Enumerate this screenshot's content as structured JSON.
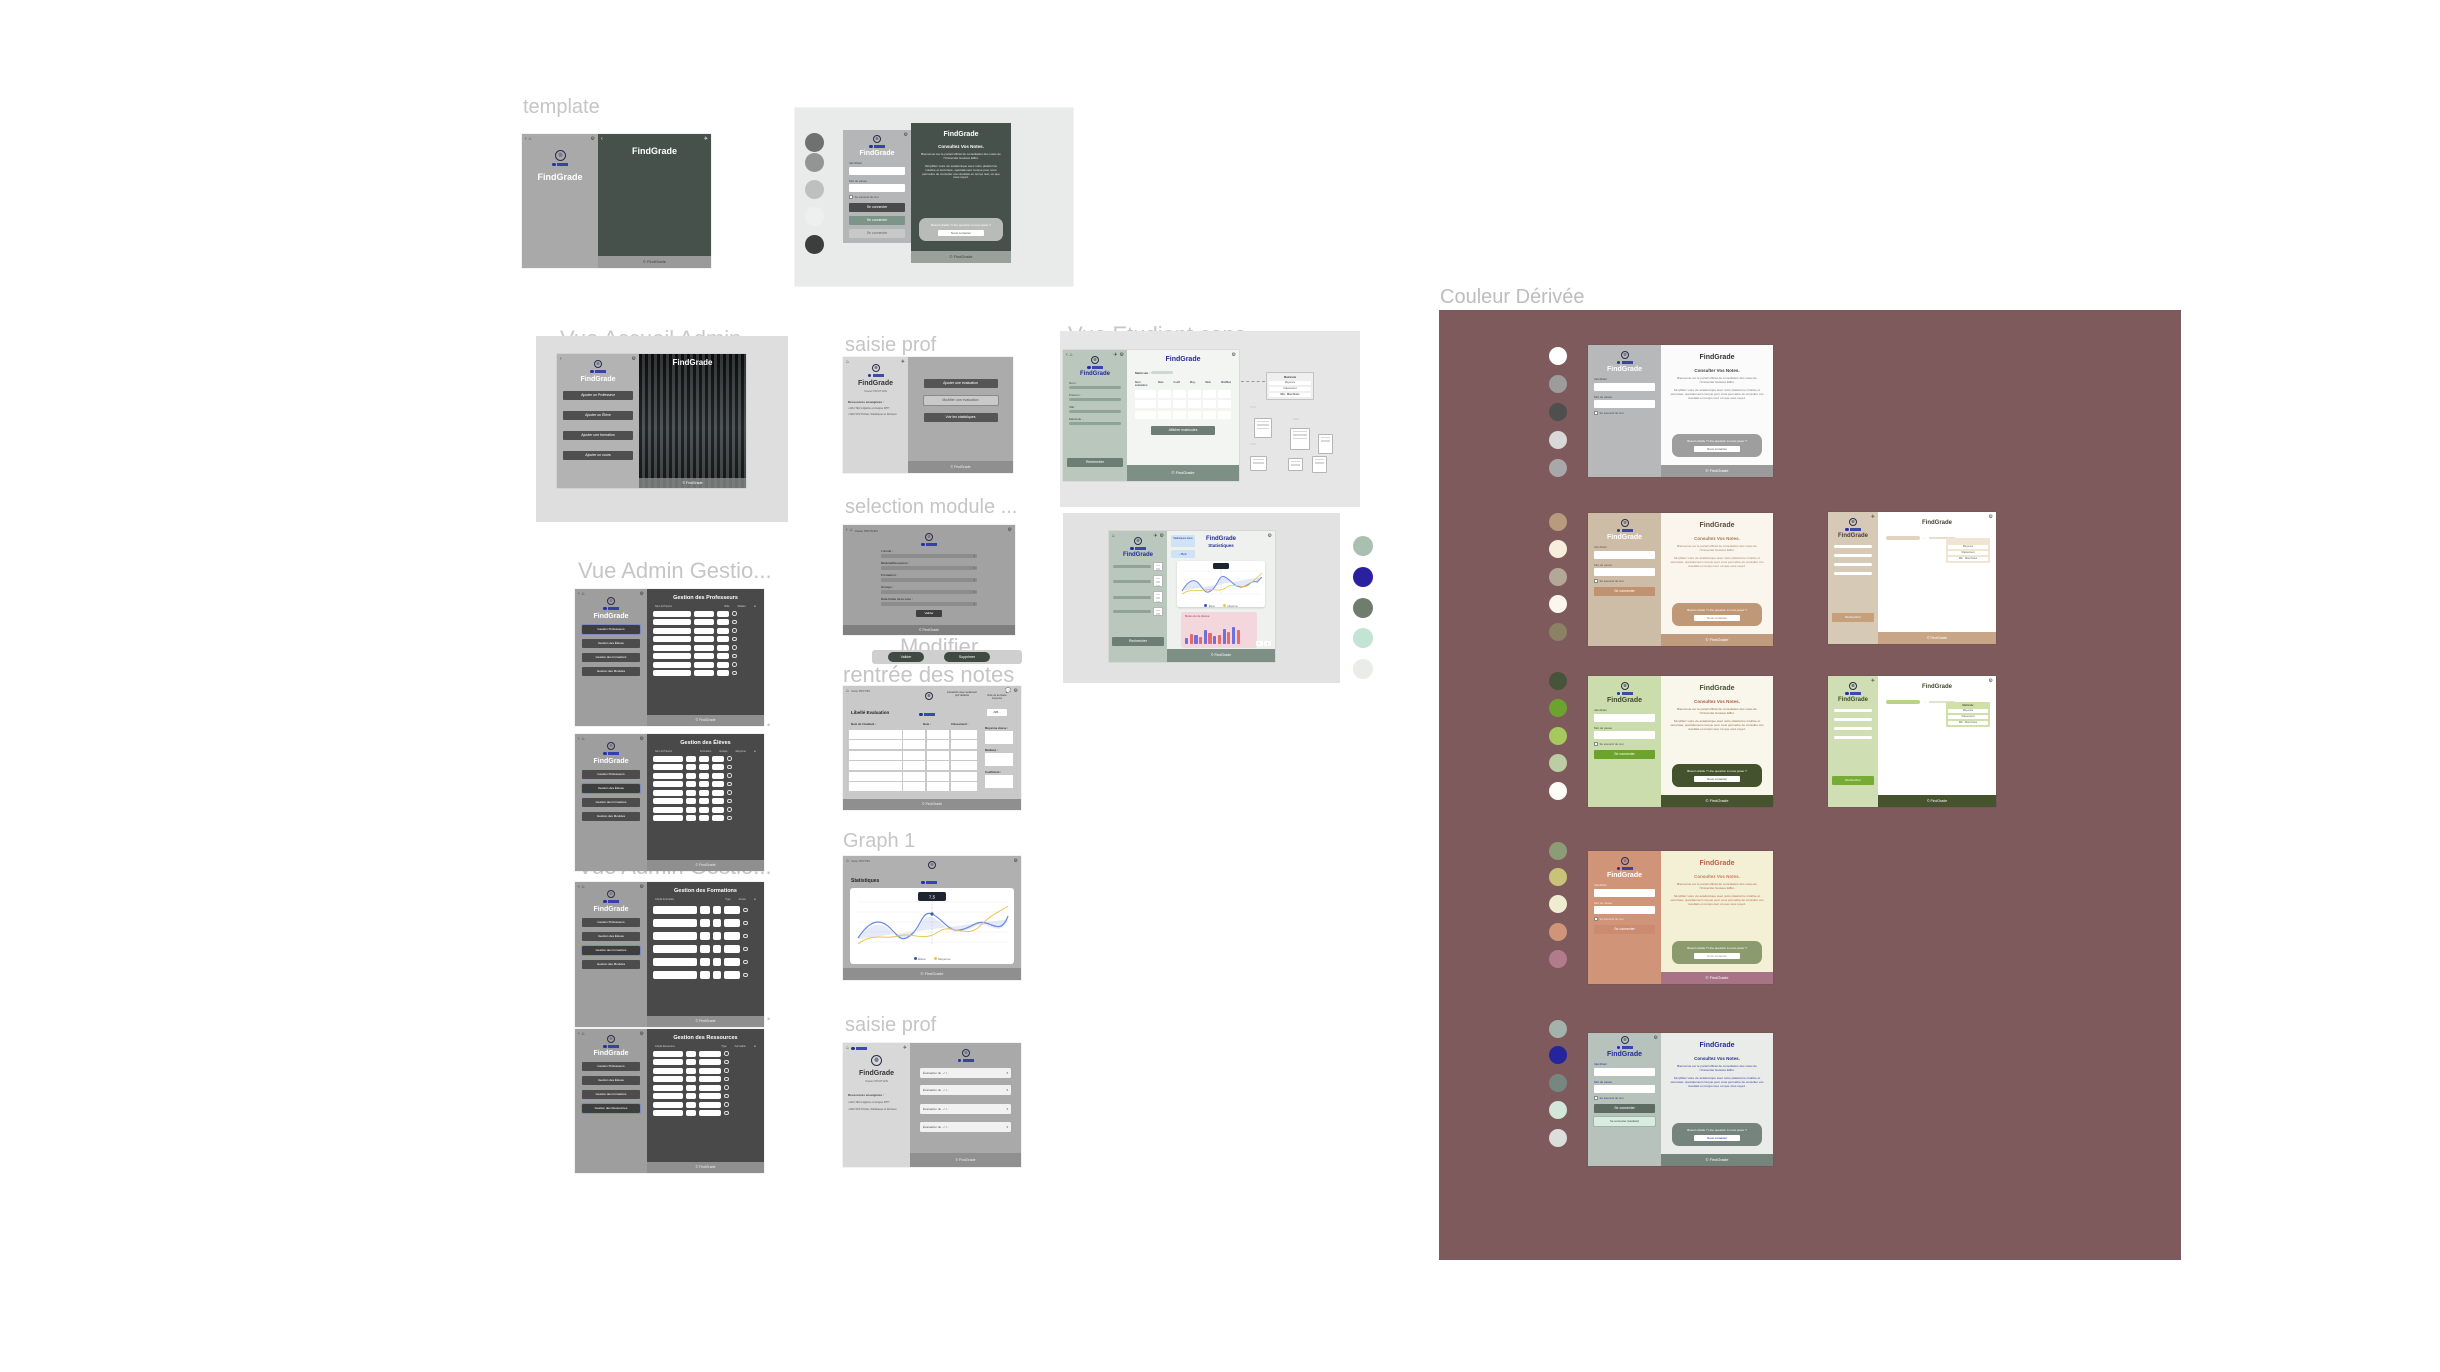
{
  "app": {
    "name": "FindGrade",
    "copyright": "© FindGrade"
  },
  "labels": {
    "template": "template",
    "accueil_admin": "Vue Accueil Admin",
    "admin_gestion": "Vue Admin Gestio...",
    "saisie_prof": "saisie prof",
    "selection_module": "selection module ...",
    "modifier": "Modifier...",
    "rentree_notes": "rentrée des notes",
    "graph1": "Graph 1",
    "etudiant_cons": "Vue Etudiant cons...",
    "etudiant_stat": "Vue Étudiant stat...",
    "couleur_derivee": "Couleur Dérivée"
  },
  "login": {
    "identifiant": "Identifiant",
    "mot_de_passe": "Mot de passe",
    "remember": "Se souvenir de moi",
    "se_connecter": "Se connecter",
    "se_connecter_etudiant": "Se connecter (étudiant)"
  },
  "welcome": {
    "heading": "Consultez Vos Notes.",
    "heading_alt": "Consulter Vos Notes.",
    "p1": "Bienvenue sur le portail officiel de consultation des notes de l'Université Gustave Eiffel.",
    "p2": "Simplifiez votre vie académique avec notre plateforme intuitive et sécurisée, spécialement conçue pour vous permettre de consulter vos résultats en temps réel, où que vous soyez.",
    "help": "Besoin d'aide ? Une question à nous poser ?",
    "contact": "Nous contacter"
  },
  "template_palette": [
    "#707070",
    "#949494",
    "#bfbfbf",
    "#efefef",
    "#3d3d3d"
  ],
  "accueil_admin": {
    "buttons": [
      "Ajouter un Professeur",
      "Ajouter un Élève",
      "Ajouter une formation",
      "Ajouter un cours"
    ]
  },
  "admin": {
    "menu": [
      "Gestion Professeurs",
      "Gestion des Élèves",
      "Gestion des formations",
      "Gestion des Modules",
      "Gestion des Ressources"
    ],
    "titles": [
      "Gestion des Professeurs",
      "Gestion des Élèves",
      "Gestion des Formations",
      "Gestion des Ressources"
    ],
    "cols_professeurs": [
      "Nom & Prénom",
      "Rôle",
      "Matière"
    ],
    "cols_eleves": [
      "Nom & Prénom",
      "Formation",
      "Groupe",
      "Moyenne"
    ],
    "cols_formations": [
      "Libellé Formation",
      "Type",
      "Année"
    ],
    "cols_ressources": [
      "Libellé Ressource",
      "Type",
      "Formation"
    ]
  },
  "prof": {
    "user": "Xavier PROTHIN",
    "universite": "Université Gustave Eiffel",
    "resources_heading": "Ressources enseignées :",
    "resources": [
      "MA1 TEC1 Algèbre et Analyse MTH",
      "MA2 STR Probas, Statistiques et Dérivées"
    ],
    "actions": [
      "Ajouter une évaluation",
      "Modifier une évaluation",
      "Voir les statistiques"
    ],
    "evaluation_row": "Évaluation du ../../.."
  },
  "selection_module": {
    "fields": [
      "L'école :",
      "Module/Ressource :",
      "Formation :",
      "Groupe :",
      "Date limite de la note :"
    ],
    "submit": "Valider"
  },
  "modifier": {
    "pills": [
      "Valider",
      "Supprimer"
    ]
  },
  "rentree": {
    "title": "Libellé Evaluation",
    "annotation_left": "interaction avec seulement prof rattaché",
    "annotation_right": "Note de la classe moyenne",
    "badge": "A|B...",
    "cols": [
      "Nom de l'étudiant :",
      "Note :",
      "Classement :"
    ],
    "side_fields": [
      "Moyenne classe :",
      "Médiane :",
      "Coefficient :"
    ]
  },
  "graph1": {
    "title": "Statistiques",
    "tooltip": "7,5",
    "legend": [
      "Élève",
      "Moyenne"
    ]
  },
  "cons": {
    "fields": [
      "Nom :",
      "Prénom :",
      "INE :",
      "Matricule :"
    ],
    "rechercher": "Rechercher",
    "search_label": "Matricule :",
    "button": "Afficher matricules",
    "info_title": "Matricule",
    "info_rows": [
      "Moyenne",
      "Classement",
      "Min · Max Notes"
    ]
  },
  "stat": {
    "badge": "Statistiques élève",
    "back": "‹ Bob",
    "subtitle": "Statistiques",
    "bar_title": "Notes de la classe",
    "palette": [
      "#a9c0b0",
      "#2a21a1",
      "#6e7d6e",
      "#c2e4d2",
      "#e9ece8"
    ],
    "bar_colors": [
      "#6f6fe0",
      "#e66a6a"
    ],
    "bars": [
      6,
      10,
      9,
      7,
      14,
      11,
      8,
      9,
      15,
      12,
      17,
      14
    ]
  },
  "chart_data": [
    {
      "type": "line",
      "title": "Graph 1 – Statistiques",
      "x": [
        1,
        2,
        3,
        4,
        5,
        6,
        7,
        8,
        9,
        10,
        11
      ],
      "series": [
        {
          "name": "Élève",
          "values": [
            8,
            11,
            10,
            7,
            13,
            9,
            8,
            11,
            10,
            9,
            12
          ]
        },
        {
          "name": "Moyenne",
          "values": [
            6,
            7,
            9,
            8,
            7,
            10,
            8,
            9,
            11,
            10,
            14
          ]
        }
      ],
      "legend_position": "bottom",
      "grid": true
    },
    {
      "type": "bar",
      "title": "Notes de la classe",
      "categories": [
        "UE1",
        "UE2",
        "UE3",
        "UE4",
        "UE5",
        "UE6"
      ],
      "series": [
        {
          "name": "Élève",
          "values": [
            6,
            9,
            14,
            8,
            15,
            17
          ]
        },
        {
          "name": "Classe",
          "values": [
            10,
            7,
            11,
            9,
            12,
            14
          ]
        }
      ]
    }
  ],
  "derivee": {
    "rows": [
      {
        "palette": [
          "#ffffff",
          "#9c9c9c",
          "#4f4f4f",
          "#d8d8d8",
          "#a8a8a8"
        ]
      },
      {
        "palette": [
          "#b69b7d",
          "#f7eddb",
          "#b3a796",
          "#fbf7ef",
          "#8b8164"
        ]
      },
      {
        "palette": [
          "#46543a",
          "#6ca32e",
          "#a5c95e",
          "#bccda4",
          "#fdfcf6"
        ]
      },
      {
        "palette": [
          "#8c9c77",
          "#c8c379",
          "#efedcf",
          "#d09579",
          "#b27b8c"
        ]
      },
      {
        "palette": [
          "#a3b3ab",
          "#24249c",
          "#77867e",
          "#d2e6da",
          "#dbdedb"
        ]
      }
    ],
    "panel_color": "#7e5a5c"
  }
}
